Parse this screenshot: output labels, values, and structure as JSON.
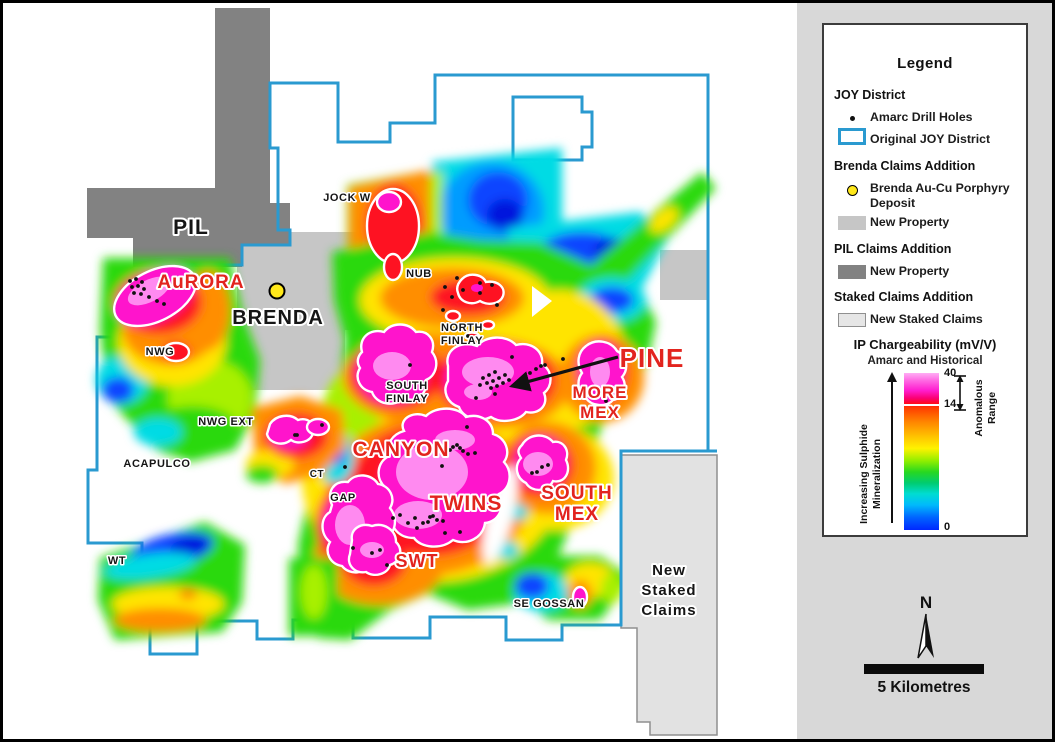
{
  "legend": {
    "title": "Legend",
    "sections": [
      {
        "heading": "JOY District",
        "items": [
          {
            "label": "Amarc Drill Holes",
            "swatch": "drill-dot"
          },
          {
            "label": "Original JOY District",
            "swatch": "joy-outline"
          }
        ]
      },
      {
        "heading": "Brenda Claims Addition",
        "items": [
          {
            "label": "Brenda Au-Cu Porphyry Deposit",
            "swatch": "deposit-dot"
          },
          {
            "label": "New Property",
            "swatch": "brenda-gray"
          }
        ]
      },
      {
        "heading": "PIL Claims Addition",
        "items": [
          {
            "label": "New Property",
            "swatch": "pil-gray"
          }
        ]
      },
      {
        "heading": "Staked Claims Addition",
        "items": [
          {
            "label": "New Staked Claims",
            "swatch": "staked-gray"
          }
        ]
      }
    ],
    "colorbar": {
      "title": "IP Chargeability (mV/V)",
      "subtitle": "Amarc and Historical",
      "tick_top": "40",
      "tick_mid": "14",
      "tick_bottom": "0",
      "left_label_line1": "Increasing Sulphide",
      "left_label_line2": "Mineralization",
      "right_label_line1": "Anomalous",
      "right_label_line2": "Range"
    }
  },
  "compass": {
    "label": "N"
  },
  "scale_bar": {
    "label": "5 Kilometres"
  },
  "colors": {
    "district_outline": "#2a9ad0",
    "red_label": "#e2241e",
    "pil_property": "#828282",
    "brenda_property": "#c6c6c6",
    "staked_claims": "#e2e2e2",
    "deposit_yellow": "#ffe81a"
  },
  "map": {
    "labels": [
      {
        "lines": [
          "PIL"
        ],
        "x": 191,
        "y": 234,
        "cls": "lbl-dark",
        "size": 21
      },
      {
        "lines": [
          "BRENDA"
        ],
        "x": 278,
        "y": 324,
        "cls": "lbl-dark",
        "size": 20
      },
      {
        "lines": [
          "AuRORA"
        ],
        "x": 201,
        "y": 288,
        "cls": "lbl-red",
        "size": 19
      },
      {
        "lines": [
          "JOCK W"
        ],
        "x": 347,
        "y": 201,
        "cls": "lbl-sm",
        "size": 11
      },
      {
        "lines": [
          "NUB"
        ],
        "x": 419,
        "y": 277,
        "cls": "lbl-sm",
        "size": 11
      },
      {
        "lines": [
          "NORTH",
          "FINLAY"
        ],
        "x": 462,
        "y": 331,
        "cls": "lbl-sm",
        "size": 11,
        "lh": 13
      },
      {
        "lines": [
          "SOUTH",
          "FINLAY"
        ],
        "x": 407,
        "y": 389,
        "cls": "lbl-sm",
        "size": 11,
        "lh": 13
      },
      {
        "lines": [
          "PINE"
        ],
        "x": 652,
        "y": 367,
        "cls": "lbl-red",
        "size": 26
      },
      {
        "lines": [
          "MORE",
          "MEX"
        ],
        "x": 600,
        "y": 398,
        "cls": "lbl-red",
        "size": 17,
        "lh": 20
      },
      {
        "lines": [
          "NWG"
        ],
        "x": 160,
        "y": 355,
        "cls": "lbl-sm",
        "size": 11
      },
      {
        "lines": [
          "NWG EXT"
        ],
        "x": 226,
        "y": 425,
        "cls": "lbl-sm",
        "size": 11
      },
      {
        "lines": [
          "ACAPULCO"
        ],
        "x": 157,
        "y": 467,
        "cls": "lbl-sm",
        "size": 11
      },
      {
        "lines": [
          "CT"
        ],
        "x": 317,
        "y": 477,
        "cls": "lbl-sm",
        "size": 10
      },
      {
        "lines": [
          "GAP"
        ],
        "x": 343,
        "y": 501,
        "cls": "lbl-sm",
        "size": 11
      },
      {
        "lines": [
          "CANYON"
        ],
        "x": 401,
        "y": 456,
        "cls": "lbl-red",
        "size": 21
      },
      {
        "lines": [
          "TWINS"
        ],
        "x": 466,
        "y": 510,
        "cls": "lbl-red",
        "size": 21
      },
      {
        "lines": [
          "SOUTH",
          "MEX"
        ],
        "x": 577,
        "y": 499,
        "cls": "lbl-red",
        "size": 19,
        "lh": 21
      },
      {
        "lines": [
          "SWT"
        ],
        "x": 417,
        "y": 567,
        "cls": "lbl-red",
        "size": 18
      },
      {
        "lines": [
          "WT"
        ],
        "x": 117,
        "y": 564,
        "cls": "lbl-sm",
        "size": 11
      },
      {
        "lines": [
          "SE GOSSAN"
        ],
        "x": 549,
        "y": 607,
        "cls": "lbl-sm",
        "size": 11
      },
      {
        "lines": [
          "New",
          "Staked",
          "Claims"
        ],
        "x": 669,
        "y": 575,
        "cls": "lbl-dark",
        "size": 15,
        "lh": 20
      }
    ],
    "drill_holes": [
      [
        130,
        281
      ],
      [
        136,
        279
      ],
      [
        142,
        282
      ],
      [
        132,
        287
      ],
      [
        138,
        286
      ],
      [
        144,
        289
      ],
      [
        134,
        293
      ],
      [
        141,
        294
      ],
      [
        149,
        297
      ],
      [
        157,
        301
      ],
      [
        164,
        304
      ],
      [
        445,
        287
      ],
      [
        452,
        297
      ],
      [
        457,
        278
      ],
      [
        463,
        290
      ],
      [
        480,
        283
      ],
      [
        492,
        285
      ],
      [
        480,
        293
      ],
      [
        497,
        305
      ],
      [
        443,
        310
      ],
      [
        468,
        336
      ],
      [
        410,
        365
      ],
      [
        512,
        357
      ],
      [
        480,
        385
      ],
      [
        483,
        378
      ],
      [
        487,
        383
      ],
      [
        489,
        375
      ],
      [
        491,
        388
      ],
      [
        493,
        381
      ],
      [
        495,
        372
      ],
      [
        495,
        394
      ],
      [
        497,
        386
      ],
      [
        499,
        378
      ],
      [
        503,
        383
      ],
      [
        505,
        375
      ],
      [
        509,
        380
      ],
      [
        476,
        398
      ],
      [
        467,
        427
      ],
      [
        530,
        373
      ],
      [
        536,
        369
      ],
      [
        541,
        366
      ],
      [
        545,
        365
      ],
      [
        563,
        359
      ],
      [
        606,
        401
      ],
      [
        612,
        412
      ],
      [
        295,
        435
      ],
      [
        322,
        425
      ],
      [
        297,
        435
      ],
      [
        442,
        466
      ],
      [
        450,
        450
      ],
      [
        453,
        447
      ],
      [
        457,
        445
      ],
      [
        460,
        448
      ],
      [
        463,
        451
      ],
      [
        468,
        454
      ],
      [
        475,
        453
      ],
      [
        345,
        467
      ],
      [
        393,
        518
      ],
      [
        400,
        515
      ],
      [
        408,
        523
      ],
      [
        415,
        518
      ],
      [
        417,
        528
      ],
      [
        423,
        523
      ],
      [
        428,
        522
      ],
      [
        430,
        517
      ],
      [
        433,
        516
      ],
      [
        437,
        520
      ],
      [
        443,
        521
      ],
      [
        445,
        533
      ],
      [
        460,
        532
      ],
      [
        353,
        548
      ],
      [
        372,
        553
      ],
      [
        380,
        550
      ],
      [
        387,
        565
      ],
      [
        532,
        473
      ],
      [
        537,
        472
      ],
      [
        542,
        467
      ],
      [
        548,
        465
      ]
    ],
    "brenda_deposit": {
      "x": 277,
      "y": 291
    },
    "pine_arrow": {
      "x1": 618,
      "y1": 357,
      "x2": 512,
      "y2": 386
    }
  }
}
